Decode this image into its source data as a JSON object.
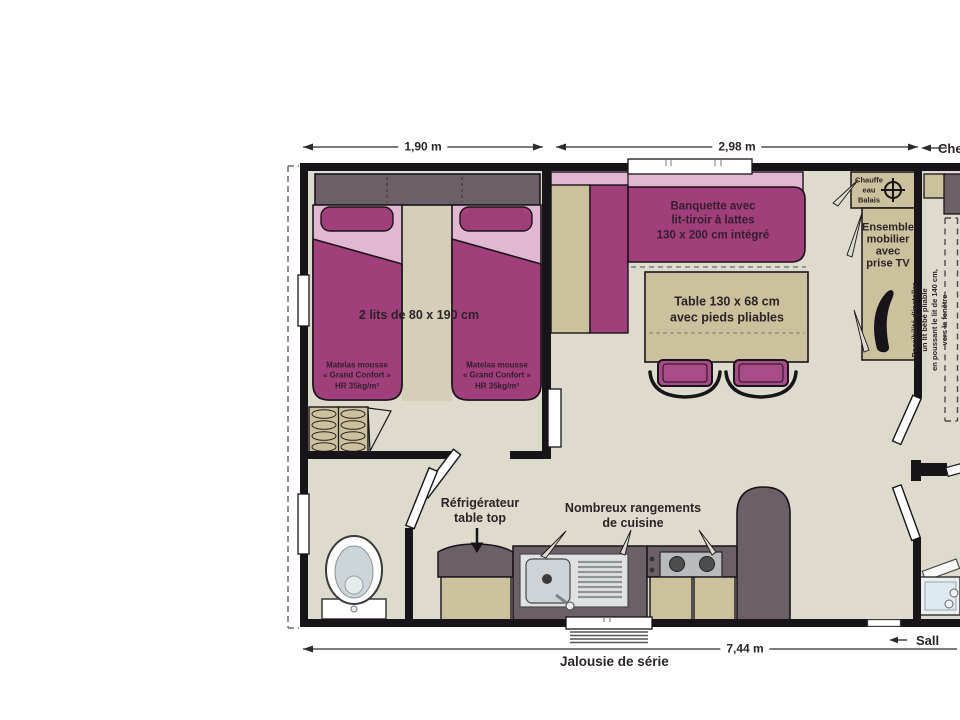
{
  "dimensions": {
    "room_left_width": "1,90 m",
    "living_width": "2,98 m",
    "total_length": "7,44 m"
  },
  "labels": {
    "beds": "2 lits de 80 x 190 cm",
    "mattress": "Matelas mousse\n« Grand Confort »\nHR 35kg/m³",
    "banquette": "Banquette avec\nlit-tiroir à lattes\n130 x 200 cm intégré",
    "table": "Table 130 x 68 cm\navec pieds pliables",
    "water_heater": "Chauffe\neau\nBalais",
    "tv_unit": "Ensemble\nmobilier\navec\nprise TV",
    "baby_bed_note": "Possibilité d'installer\nun lit bébé pliable\nen poussant le lit de 140 cm,\nvers la fenêtre",
    "fridge": "Réfrigérateur\ntable top",
    "kitchen_storage": "Nombreux rangements\nde cuisine",
    "window_note": "Jalousie de série",
    "top_right_partial": "Che",
    "bottom_right_partial": "Sall"
  },
  "symbols": {
    "water_heater": "crosshair-icon",
    "direction_arrows": "left-arrow-icon"
  },
  "colors": {
    "wall": "#19141a",
    "floor": "#dedacc",
    "aisle": "#d6cfb8",
    "accent_magenta": "#a13e7c",
    "chair_magenta": "#a84b88",
    "light_pink": "#e2b7d1",
    "tan": "#cbc19c",
    "counter_gray": "#6b6067",
    "stainless": "#dfe2e4",
    "white": "#ffffff"
  }
}
